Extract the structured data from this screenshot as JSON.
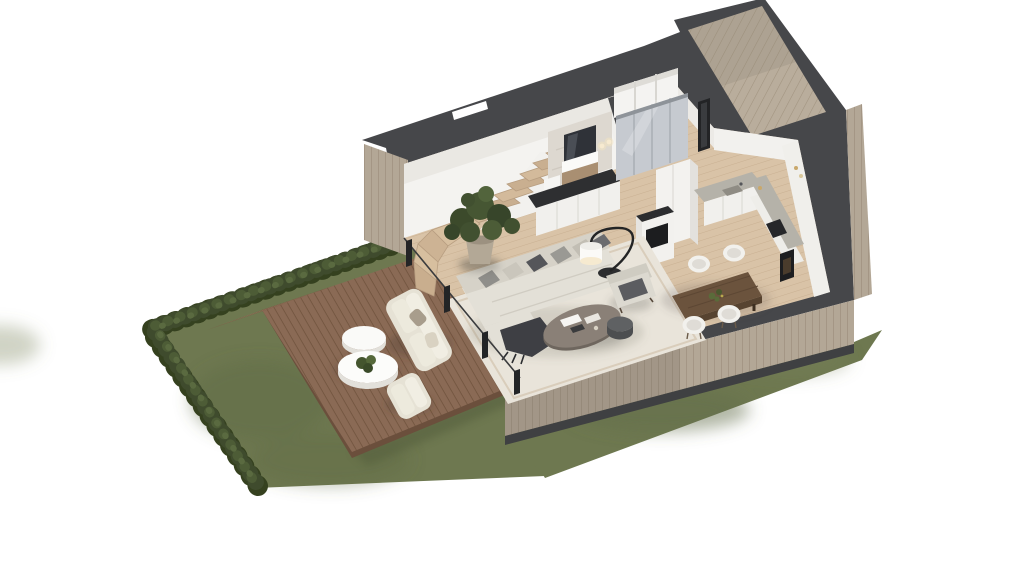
{
  "scene": {
    "type": "architectural-3d-floor-plan-render",
    "view": "isometric-cutaway-top",
    "background_color": "#ffffff"
  },
  "palette": {
    "wall_cut_top": "#46474a",
    "exterior_cladding": "#b3a796",
    "porch_cladding": "#b9ad9c",
    "interior_floor": "#d9c3a7",
    "deck_wood": "#8a6a55",
    "lawn_green": "#6e7850",
    "hedge_green": "#3f4b2d",
    "rug_cream": "#e9e4da",
    "sofa_cream": "#e3e0d7",
    "countertop_gray": "#b5b2a9",
    "cabinet_white": "#f1f0ed",
    "dining_table_wood": "#6b533d",
    "stair_wood": "#d3ba9b",
    "accent_black": "#26272a"
  },
  "garden": {
    "lawn": {
      "shape": "L-shaped lawn wrapping house front",
      "color": "#6e7850"
    },
    "hedge": {
      "sides": [
        "west boundary",
        "north-west boundary"
      ],
      "color": "#3f4b2d"
    },
    "deck": {
      "material": "wood planks",
      "steps_to_lawn": 4,
      "furniture": [
        {
          "item": "outdoor-sofa",
          "color": "#efece2"
        },
        {
          "item": "outdoor-armchair",
          "color": "#efece2"
        },
        {
          "item": "round-side-table-large",
          "color": "#fafaf8",
          "decor": "small green plant"
        },
        {
          "item": "round-side-table-small",
          "color": "#fafaf8"
        }
      ]
    }
  },
  "house": {
    "construction": "cutaway walls with dark cut plane, wood-clad exterior",
    "glazing": "full-height sliding glass wall facing deck",
    "entry": "recessed wood-clad porch at north-east corner",
    "rooms": [
      {
        "name": "living-room",
        "furniture": [
          "L-shaped sectional sofa with pillows",
          "dark throw blanket",
          "oval coffee table with books",
          "round side table",
          "arc floor lamp",
          "lounge armchair",
          "cream area rug"
        ]
      },
      {
        "name": "dining-area",
        "furniture": [
          "rectangular walnut dining table",
          "four white shell chairs",
          "greenery centerpiece"
        ]
      },
      {
        "name": "kitchen",
        "furniture": [
          "L-shaped white cabinets",
          "gray stone countertop",
          "sink",
          "built-in oven",
          "tall cabinet column",
          "wall niche fireplace"
        ]
      },
      {
        "name": "wc-bathroom",
        "furniture": [
          "marble feature wall",
          "recessed mirror",
          "wood vanity with basin",
          "toilet",
          "two wall sconces"
        ]
      },
      {
        "name": "hallway",
        "furniture": [
          "open cubby shelf",
          "glass sliding wardrobe",
          "entry door"
        ]
      },
      {
        "name": "staircase",
        "furniture": [
          "wood winder staircase",
          "potted fiddle-leaf fig"
        ]
      },
      {
        "name": "media-column",
        "furniture": [
          "white column with black media/fireplace recess"
        ]
      }
    ]
  }
}
